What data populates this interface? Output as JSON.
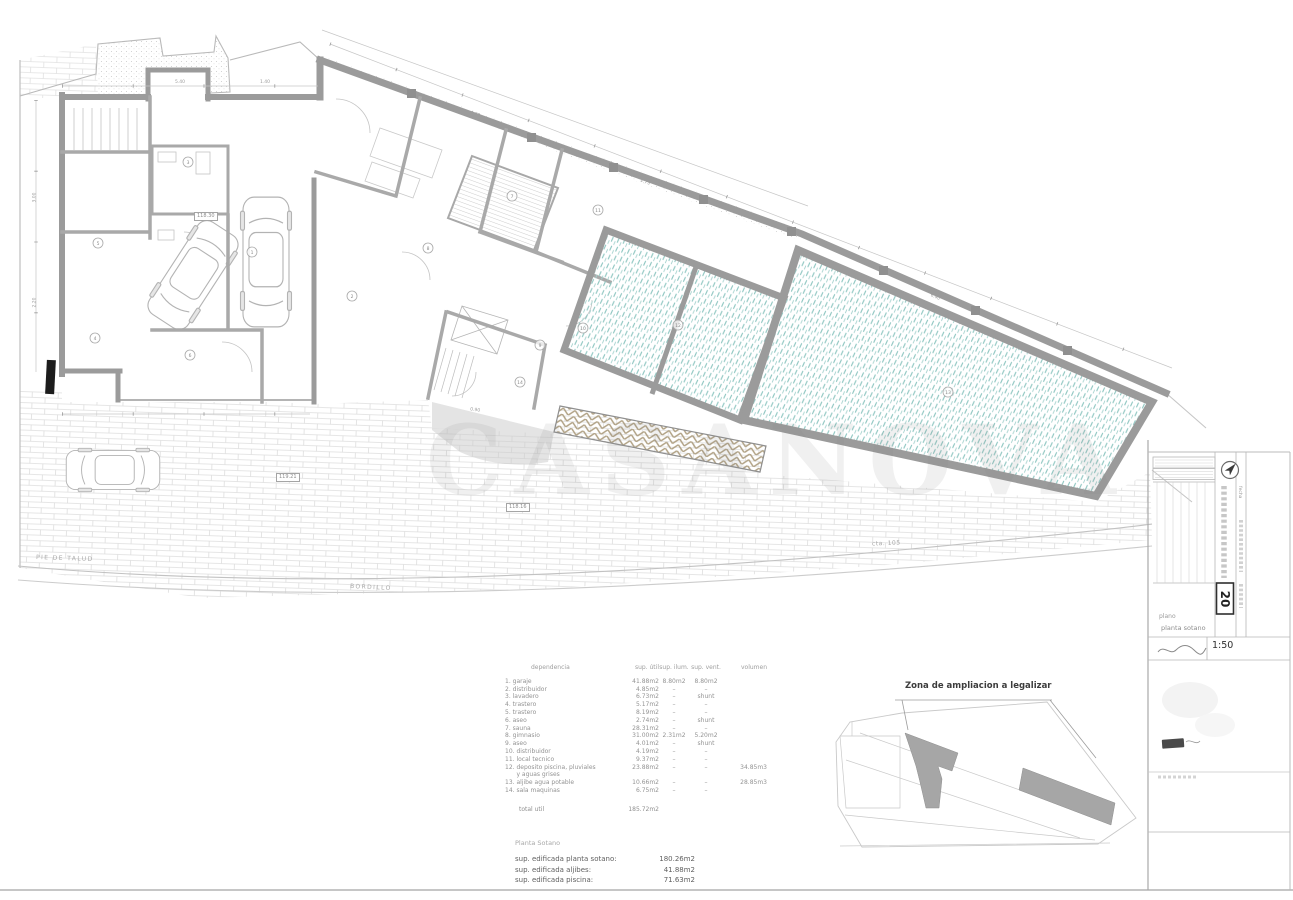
{
  "watermark": "CASANOVA",
  "site": {
    "pie_de_talud": "PIE DE TALUD",
    "bordillo": "BORDILLO",
    "cota_street": "cta. 105",
    "levels": [
      "118.30",
      "119.21",
      "118.16"
    ],
    "dims": [
      "3.00",
      "2.20",
      "5.40",
      "1.40",
      "4.60",
      "2.73",
      "6.40",
      "0.90"
    ]
  },
  "room_markers": [
    "1",
    "2",
    "3",
    "4",
    "5",
    "6",
    "7",
    "8",
    "9",
    "10",
    "11",
    "12",
    "13",
    "14"
  ],
  "areas_table": {
    "headers": [
      "dependencia",
      "sup. útil",
      "sup. ilum.",
      "sup. vent.",
      "volumen"
    ],
    "rows": [
      [
        "1. garaje",
        "41.88m2",
        "8.80m2",
        "8.80m2",
        ""
      ],
      [
        "2. distribuidor",
        "4.85m2",
        "–",
        "–",
        ""
      ],
      [
        "3. lavadero",
        "6.73m2",
        "–",
        "shunt",
        ""
      ],
      [
        "4. trastero",
        "5.17m2",
        "–",
        "–",
        ""
      ],
      [
        "5. trastero",
        "8.19m2",
        "–",
        "–",
        ""
      ],
      [
        "6. aseo",
        "2.74m2",
        "–",
        "shunt",
        ""
      ],
      [
        "7. sauna",
        "28.31m2",
        "–",
        "–",
        ""
      ],
      [
        "8. gimnasio",
        "31.00m2",
        "2.31m2",
        "5.20m2",
        ""
      ],
      [
        "9. aseo",
        "4.01m2",
        "–",
        "shunt",
        ""
      ],
      [
        "10. distribuidor",
        "4.19m2",
        "–",
        "–",
        ""
      ],
      [
        "11. local tecnico",
        "9.37m2",
        "–",
        "–",
        ""
      ],
      [
        "12. deposito piscina, pluviales",
        "23.88m2",
        "–",
        "–",
        "34.85m3"
      ],
      [
        "      y aguas grises",
        "",
        "",
        "",
        ""
      ],
      [
        "13. aljibe agua potable",
        "10.66m2",
        "–",
        "–",
        "28.85m3"
      ],
      [
        "14. sala maquinas",
        "6.75m2",
        "–",
        "–",
        ""
      ]
    ],
    "total_label": "total util",
    "total_value": "185.72m2"
  },
  "summary": {
    "title": "Planta Sotano",
    "rows": [
      {
        "label": "sup. edificada planta sotano:",
        "value": "180.26m2"
      },
      {
        "label": "sup. edificada aljibes:",
        "value": "41.88m2"
      },
      {
        "label": "sup. edificada piscina:",
        "value": "71.63m2"
      }
    ]
  },
  "inset": {
    "label": "Zona de ampliacion a legalizar"
  },
  "titleblock": {
    "number": "20",
    "scale": "1:50",
    "plano_label": "plano",
    "plano_value": "planta sotano",
    "fecha_label": "fecha"
  },
  "colors": {
    "pool_hatch": "#8ec6c1",
    "wall": "#9b9b9b",
    "ramp_hatch": "#b0a184",
    "terrace_line": "#dadada",
    "watermark": "#e6e6e6"
  }
}
